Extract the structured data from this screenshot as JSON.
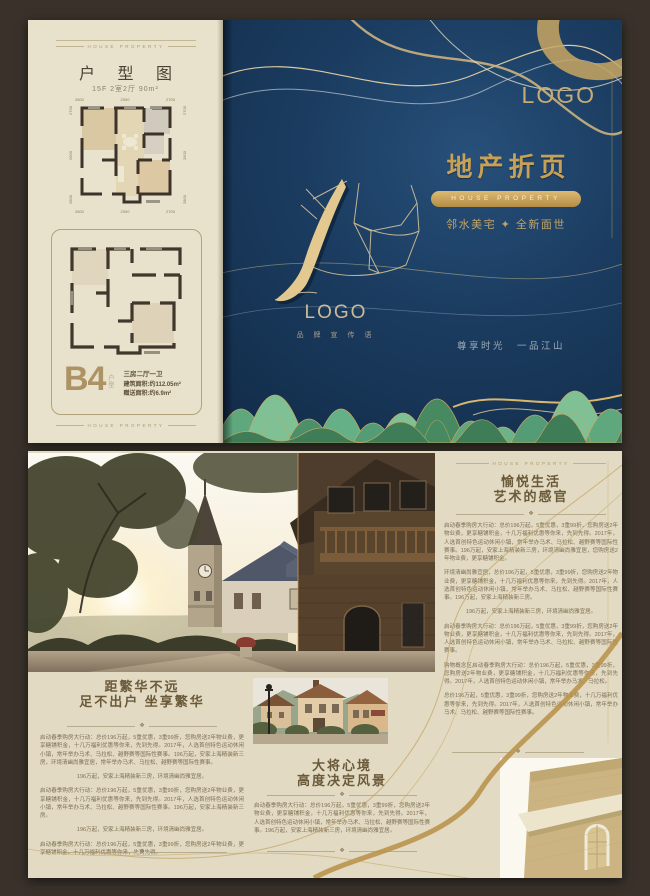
{
  "colors": {
    "gold": "#c8a763",
    "navy": "#16304e",
    "cream": "#e7e0cb",
    "mountain_green": "#5fa77d",
    "outer_brown": "#39312a"
  },
  "page1": {
    "left_panel": {
      "header_small": "HOUSE PROPERTY",
      "title": "户 型 图",
      "subtitle": "15F 2室2厅 90m²",
      "plan1_dims": {
        "top": [
          "2600",
          "2900",
          "2700"
        ],
        "bottom": [
          "2600",
          "2900",
          "2700"
        ],
        "left": [
          "2700",
          "2600",
          "2800"
        ],
        "right": [
          "2700",
          "2600",
          "2800"
        ]
      },
      "unit": {
        "code": "B4",
        "code_suffix_1": "户",
        "code_suffix_2": "型",
        "spec": "三房二厅一卫",
        "area_build": "建筑面积:约112.05m²",
        "area_gift": "赠送面积:约6.9m²"
      },
      "footer_small": "HOUSE PROPERTY"
    },
    "right_panel": {
      "logo_top": "LOGO",
      "main_title": "地产折页",
      "pill_label": "HOUSE PROPERTY",
      "tagline": "邻水美宅 ✦ 全新面世",
      "center_logo": "LOGO",
      "center_logo_sub": "品 牌 宣 传 语",
      "slogan": "尊享时光　一品江山"
    }
  },
  "page2": {
    "right_column": {
      "header_small": "HOUSE PROPERTY",
      "title_line1": "愉悦生活",
      "title_line2": "艺术的感官",
      "ornament": "❖",
      "paragraphs": [
        "启动春季购房大行动：总价196万起，5重优惠，3重99折，您购房送2年物业费，更享糖铺积金，十几万福利优惠等你来，先到先得。2017年，人选首创特色运动休闲小镇，常年举办马术、马拉松、越野赛等国际性赛事。196万起，安家上海精装新三房，环境清幽尚雅宜居，您购房送2年物业费，更享糖铺积金。",
        "环境清幽尚雅宜居，总价196万起，5重优惠，3重99折，您购房送2年物业费，更享糖铺积金，十几万福利优惠等你来，先到先得。2017年，人选首创特色运动休闲小镇，常年举办马术、马拉松、越野赛等国际性赛事。196万起，安家上海精装新三房。",
        "196万起，安家上海精装新三房，环境清幽尚雅宜居。",
        "启动春季购房大行动：总价196万起，5重优惠，3重99折，您购房送2年物业费，更享糖铺积金，十几万福利优惠等你来，先到先得。2017年，人选首创特色运动休闲小镇，常年举办马术、马拉松、越野赛等国际性赛事。",
        "购物概念区启动春季购房大行动：总价196万起，5重优惠，3重99折，您购房送2年物业费，更享糖铺积金，十几万福利优惠等你来，先到先得。2017年，人选首创特色运动休闲小镇，常年举办马术、马拉松。",
        "总价196万起，5重优惠，3重99折，您购房送2年物业费，十几万福利优惠等你来，先到先得。2017年，人选首创特色运动休闲小镇，常年举办马术、马拉松、越野赛等国际性赛事。"
      ]
    },
    "left_block": {
      "title_line1": "距繁华不远",
      "title_line2": "足不出户 坐享繁华",
      "ornament": "❖",
      "paragraphs": [
        "启动春季购房大行动：总价196万起，5重优惠，3重99折，您购房送2年物业费，更享糖铺积金，十几万福利优惠等你来，先到先得。2017年，人选首创特色运动休闲小镇，常年举办马术、马拉松、越野赛等国际性赛事。196万起，安家上海精装新三房，环境清幽尚雅宜居，常年举办马术、马拉松、越野赛等国际性赛事。",
        "196万起，安家上海精装新三房，环境清幽尚雅宜居。",
        "启动春季购房大行动：总价196万起，5重优惠，3重99折，您购房送2年物业费，更享糖铺积金，十几万福利优惠等你来，先到先得。2017年，人选首创特色运动休闲小镇，常年举办马术、马拉松、越野赛等国际性赛事。196万起，安家上海精装新三房。",
        "196万起，安家上海精装新三房，环境清幽尚雅宜居。",
        "启动春季购房大行动：总价196万起，5重优惠，3重99折，您购房送2年物业费，更享糖铺积金，十几万福利优惠等你来，先到先得。"
      ]
    },
    "mid_block": {
      "title_line1": "大将心境",
      "title_line2": "高度决定风景",
      "ornament": "❖",
      "paragraphs": [
        "启动春季购房大行动：总价196万起，5重优惠，3重99折，您购房送2年物业费，更享糖铺积金，十几万福利优惠等你来，先到先得。2017年，人选首创特色运动休闲小镇，常年举办马术、马拉松、越野赛等国际性赛事。196万起，安家上海精装新三房，环境清幽尚雅宜居。"
      ]
    }
  }
}
